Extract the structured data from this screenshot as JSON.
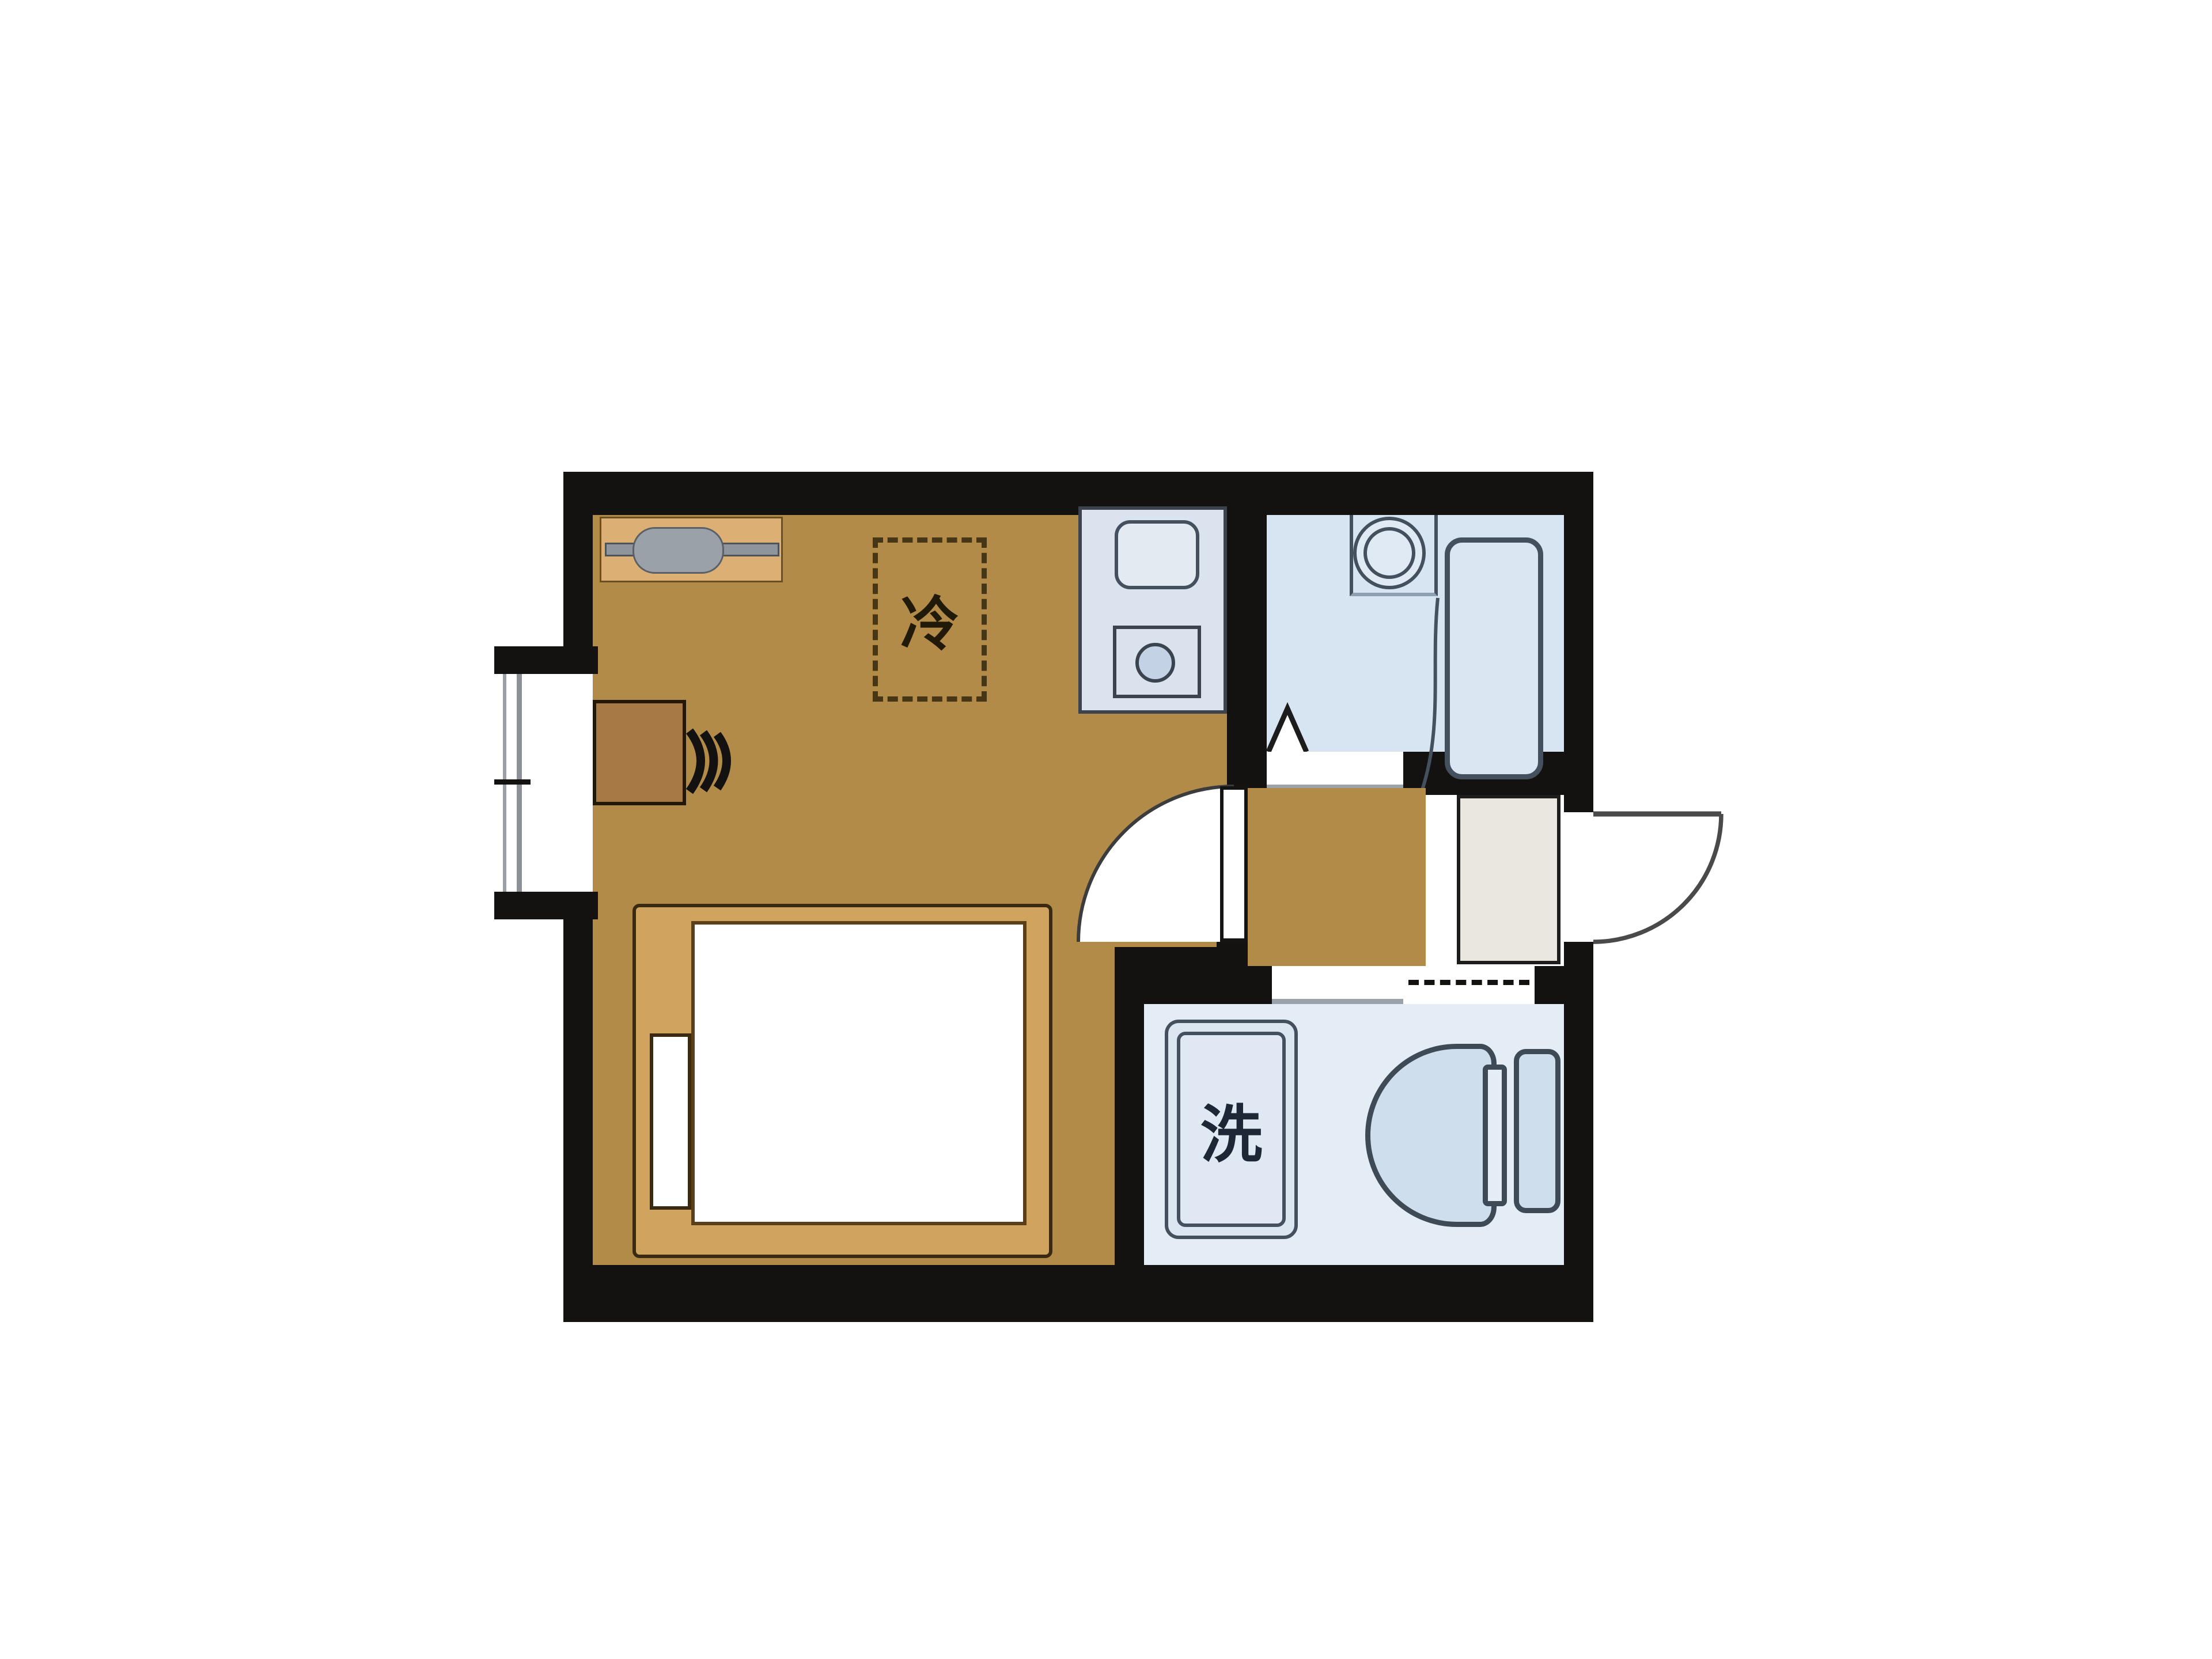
{
  "plan": {
    "type": "japanese-studio-floorplan",
    "labels": {
      "refrigerator_space": "冷",
      "washing_machine": "洗"
    },
    "rooms": [
      {
        "name": "main-room"
      },
      {
        "name": "kitchen-area"
      },
      {
        "name": "bathroom"
      },
      {
        "name": "hallway"
      },
      {
        "name": "entrance"
      },
      {
        "name": "washroom-toilet"
      }
    ],
    "fixtures": [
      "hanger-shelf",
      "refrigerator-space",
      "kitchen-sink",
      "gas-stove",
      "window",
      "desk",
      "chair",
      "bed",
      "mattress",
      "pillow",
      "interior-door",
      "bathroom-folding-door",
      "washbasin",
      "bathtub",
      "shoe-cabinet",
      "entrance-door",
      "washing-machine-pan",
      "toilet"
    ],
    "colors": {
      "wall": "#131210",
      "main_floor": "#b28b49",
      "bed_frame": "#d0a35f",
      "mattress": "#ffffff",
      "desk": "#a77a45",
      "shelf": "#dcaf75",
      "bathroom_floor": "#d7e5f2",
      "washroom_floor": "#e4edf5",
      "kitchen_unit": "#dbe3ee",
      "fixture_fill": "#d3e0ee",
      "fixture_line": "#44505e",
      "entrance_cabinet": "#eae7e0",
      "background": "#ffffff"
    }
  }
}
